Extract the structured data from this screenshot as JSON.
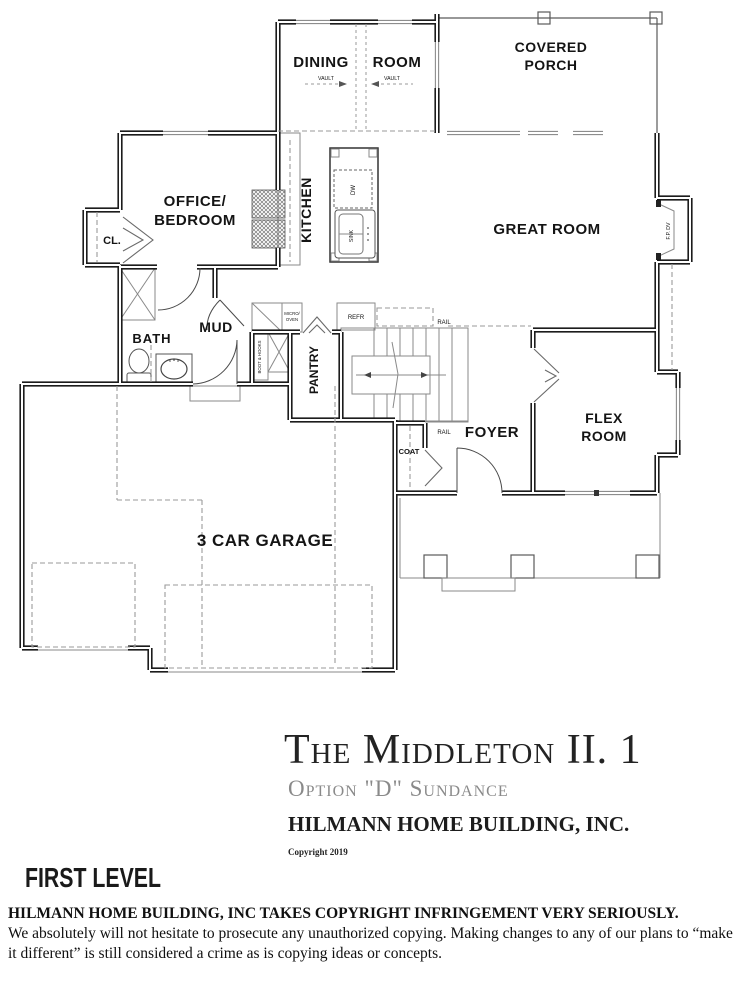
{
  "plan": {
    "rooms": {
      "dining": {
        "word1": "DINING",
        "word2": "ROOM"
      },
      "covered_porch": {
        "line1": "COVERED",
        "line2": "PORCH"
      },
      "office": {
        "line1": "OFFICE/",
        "line2": "BEDROOM"
      },
      "closet": "CL.",
      "kitchen": "KITCHEN",
      "great_room": "GREAT ROOM",
      "bath": "BATH",
      "mud": "MUD",
      "pantry": "PANTRY",
      "foyer": "FOYER",
      "flex": {
        "line1": "FLEX",
        "line2": "ROOM"
      },
      "coat": "COAT",
      "garage": "3 CAR GARAGE"
    },
    "fixtures": {
      "vault": "VAULT",
      "dw": "DW",
      "sink": "SINK",
      "refr": "REFR",
      "micro_line1": "MICRO/",
      "micro_line2": "OVEN",
      "boot_hooks": "BOOT & HOOKS",
      "fireplace": "F.P. DV",
      "rail": "RAIL"
    }
  },
  "title_block": {
    "plan_name": "The Middleton II. 1",
    "option": "Option \"D\" Sundance",
    "company": "HILMANN HOME BUILDING, INC.",
    "copyright": "Copyright 2019",
    "level": "FIRST LEVEL"
  },
  "legal": {
    "headline": "HILMANN HOME BUILDING, INC TAKES COPYRIGHT INFRINGEMENT VERY SERIOUSLY.",
    "body": "We absolutely will not hesitate to prosecute any unauthorized copying.  Making changes to any of our plans to “make it different” is still considered a crime as is copying ideas or concepts."
  },
  "colors": {
    "wall": "#1c1c1c",
    "thin_line": "#5a5a5a",
    "dashed_line": "#9a9a9a",
    "label_text": "#141414",
    "muted_text": "#8a8a8a"
  }
}
